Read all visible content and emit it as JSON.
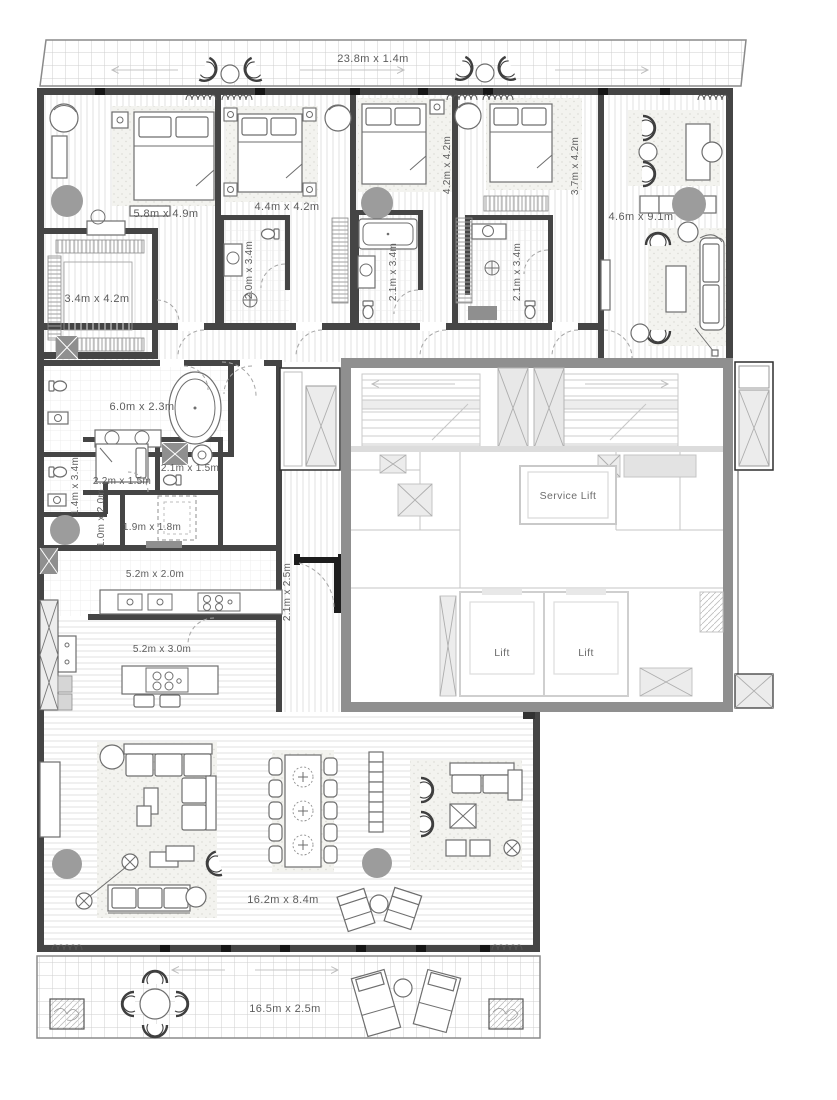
{
  "labels": {
    "balcony": "23.8m x 1.4m",
    "master_bedroom": "5.8m x 4.9m",
    "bedroom_2": "4.4m x 4.2m",
    "bedroom_3": "4.2m x 4.2m",
    "bedroom_4": "3.7m x 4.2m",
    "study": "4.6m x 9.1m",
    "walk_in_closet": "3.4m x 4.2m",
    "bathroom_2": "2.0m x 3.4m",
    "bathroom_3": "2.1m x 3.4m",
    "bathroom_4": "2.1m x 3.4m",
    "master_bathroom": "6.0m x 2.3m",
    "powder_room": "1.4m x 3.4m",
    "maid_room": "2.2m x 1.5m",
    "laundry": "2.1m x 1.5m",
    "corridor": "1.0m x 2.0m",
    "store": "1.9m x 1.8m",
    "kitchen": "5.2m x 2.0m",
    "open_kitchen": "5.2m x 3.0m",
    "entry": "2.1m x 2.5m",
    "service_lift": "Service Lift",
    "lift_1": "Lift",
    "lift_2": "Lift",
    "living_dining": "16.2m x 8.4m",
    "terrace": "16.5m x 2.5m"
  },
  "colors": {
    "apartment_wall": "#454545",
    "core_wall": "#8f8f8f",
    "column": "#9c9c9c",
    "label_text": "#5c5c5c"
  }
}
